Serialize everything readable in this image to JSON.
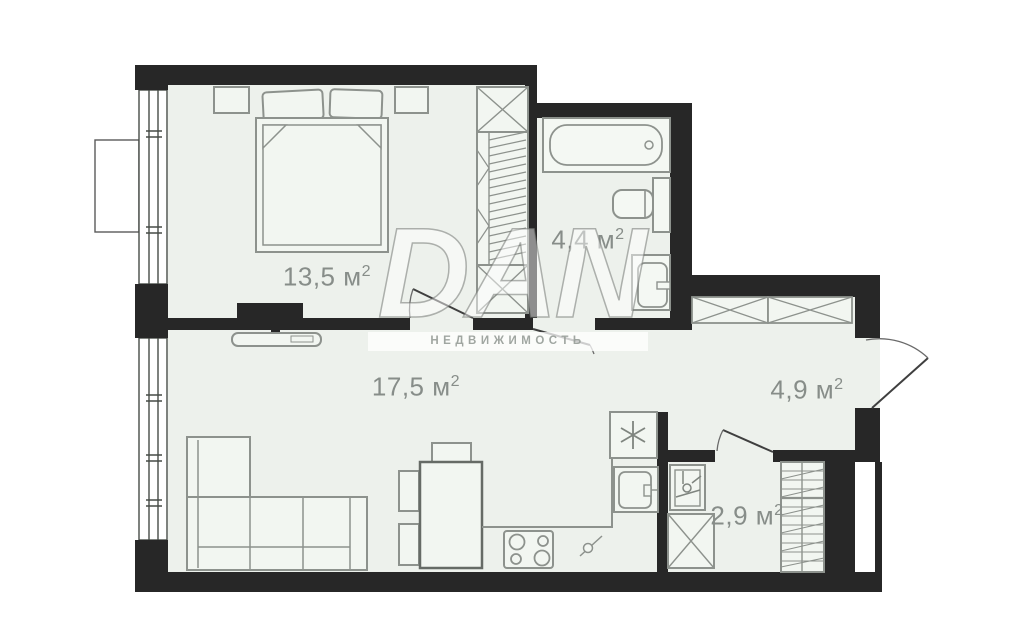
{
  "watermark": {
    "brand": "DAN",
    "tagline": "НЕДВИЖИМОСТЬ"
  },
  "rooms": {
    "bedroom": {
      "label": "13,5 м",
      "sup": "2"
    },
    "bathroom": {
      "label": "4,4 м",
      "sup": "2"
    },
    "living_kitchen": {
      "label": "17,5 м",
      "sup": "2"
    },
    "hallway": {
      "label": "4,9 м",
      "sup": "2"
    },
    "storage": {
      "label": "2,9 м",
      "sup": "2"
    }
  },
  "colors": {
    "wall": "#272727",
    "floor": "#edf1ec",
    "fixture": "#f2f6f1",
    "furniture_line": "#8d928d",
    "label_text": "#878d89"
  }
}
